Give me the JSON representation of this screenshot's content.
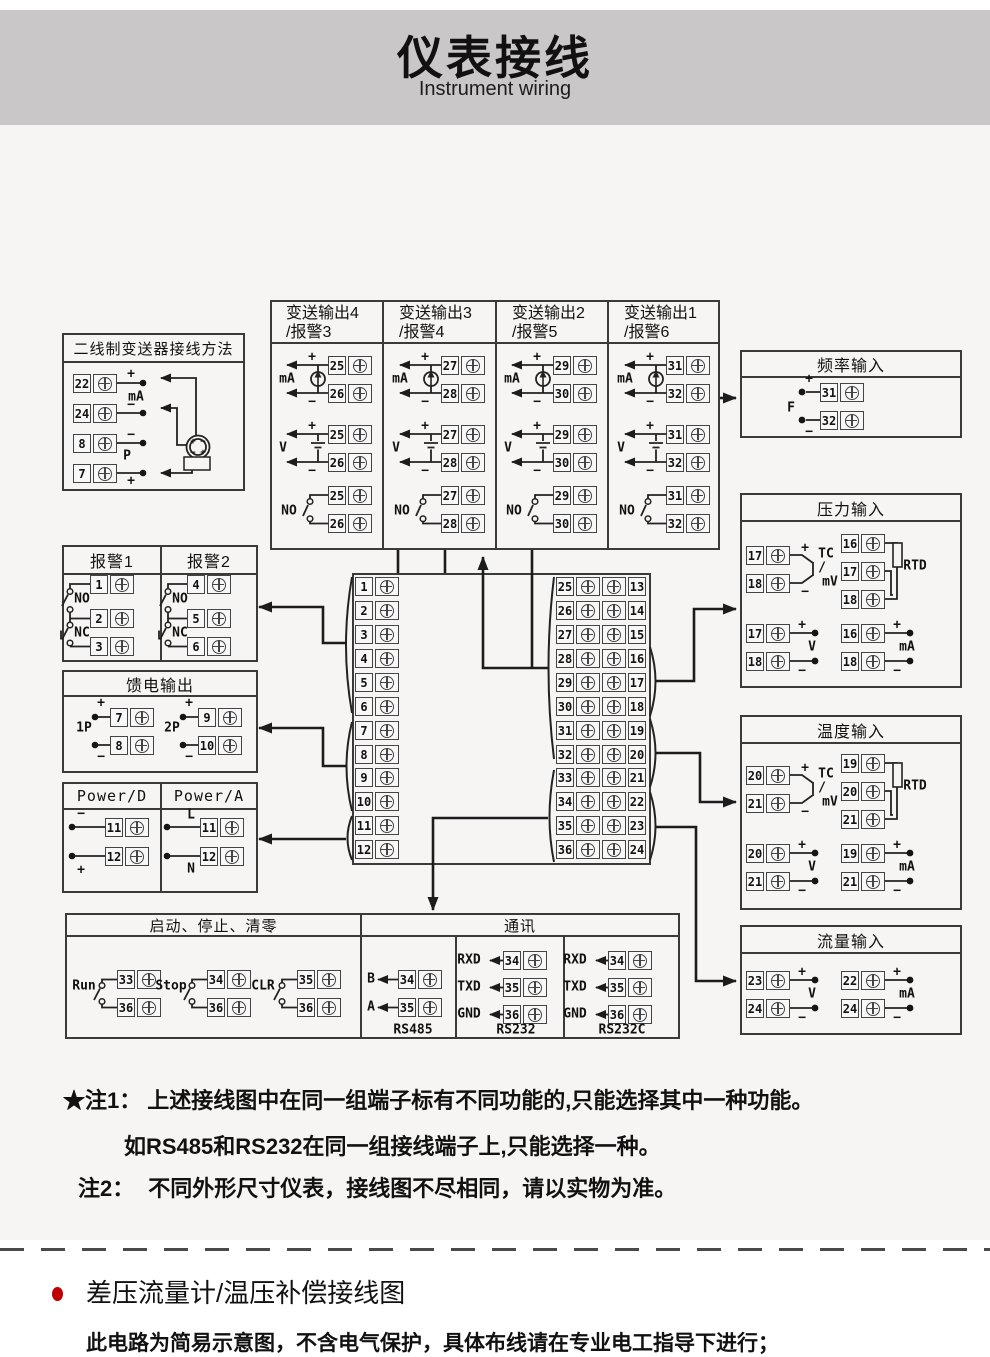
{
  "page": {
    "title": "仪表接线",
    "subtitle": "Instrument wiring"
  },
  "boxes": {
    "two_wire": {
      "title": "二线制变送器接线方法"
    },
    "transmit": {
      "columns": [
        {
          "t1": "变送输出4",
          "t2": "/报警3"
        },
        {
          "t1": "变送输出3",
          "t2": "/报警4"
        },
        {
          "t1": "变送输出2",
          "t2": "/报警5"
        },
        {
          "t1": "变送输出1",
          "t2": "/报警6"
        }
      ]
    },
    "freq": {
      "title": "频率输入"
    },
    "alarm1": {
      "title": "报警1"
    },
    "alarm2": {
      "title": "报警2"
    },
    "feed": {
      "title": "馈电输出"
    },
    "powerD": {
      "title": "Power/D"
    },
    "powerA": {
      "title": "Power/A"
    },
    "pressure": {
      "title": "压力输入"
    },
    "temperature": {
      "title": "温度输入"
    },
    "flow": {
      "title": "流量输入"
    },
    "control": {
      "title": "启动、停止、清零"
    },
    "comm": {
      "title": "通讯"
    }
  },
  "notes": {
    "n1_prefix": "★注1：",
    "n1_text": "上述接线图中在同一组端子标有不同功能的,只能选择其中一种功能。",
    "n1_line2": "如RS485和RS232在同一组接线端子上,只能选择一种。",
    "n2_prefix": "注2：",
    "n2_text": "不同外形尺寸仪表，接线图不尽相同，请以实物为准。"
  },
  "section": {
    "heading": "差压流量计/温压补偿接线图",
    "body": "此电路为简易示意图，不含电气保护，具体布线请在专业电工指导下进行；",
    "bullet_color": "#c00000"
  },
  "diagram": {
    "terminals": [
      [
        73,
        249,
        "22"
      ],
      [
        73,
        279,
        "24"
      ],
      [
        73,
        309,
        "8"
      ],
      [
        73,
        339,
        "7"
      ],
      [
        328,
        231,
        "25"
      ],
      [
        328,
        259,
        "26"
      ],
      [
        328,
        300,
        "25"
      ],
      [
        328,
        328,
        "26"
      ],
      [
        328,
        361,
        "25"
      ],
      [
        328,
        389,
        "26"
      ],
      [
        441,
        231,
        "27"
      ],
      [
        441,
        259,
        "28"
      ],
      [
        441,
        300,
        "27"
      ],
      [
        441,
        328,
        "28"
      ],
      [
        441,
        361,
        "27"
      ],
      [
        441,
        389,
        "28"
      ],
      [
        553,
        231,
        "29"
      ],
      [
        553,
        259,
        "30"
      ],
      [
        553,
        300,
        "29"
      ],
      [
        553,
        328,
        "30"
      ],
      [
        553,
        361,
        "29"
      ],
      [
        553,
        389,
        "30"
      ],
      [
        666,
        231,
        "31"
      ],
      [
        666,
        259,
        "32"
      ],
      [
        666,
        300,
        "31"
      ],
      [
        666,
        328,
        "32"
      ],
      [
        666,
        361,
        "31"
      ],
      [
        666,
        389,
        "32"
      ],
      [
        820,
        258,
        "31"
      ],
      [
        820,
        286,
        "32"
      ],
      [
        90,
        450,
        "1"
      ],
      [
        90,
        484,
        "2"
      ],
      [
        90,
        512,
        "3"
      ],
      [
        187,
        450,
        "4"
      ],
      [
        187,
        484,
        "5"
      ],
      [
        187,
        512,
        "6"
      ],
      [
        110,
        583,
        "7"
      ],
      [
        110,
        611,
        "8"
      ],
      [
        198,
        583,
        "9"
      ],
      [
        198,
        611,
        "10"
      ],
      [
        105,
        693,
        "11"
      ],
      [
        105,
        722,
        "12"
      ],
      [
        200,
        693,
        "11"
      ],
      [
        200,
        722,
        "12"
      ],
      [
        355,
        452,
        "1"
      ],
      [
        355,
        476,
        "2"
      ],
      [
        355,
        500,
        "3"
      ],
      [
        355,
        524,
        "4"
      ],
      [
        355,
        548,
        "5"
      ],
      [
        355,
        572,
        "6"
      ],
      [
        355,
        596,
        "7"
      ],
      [
        355,
        620,
        "8"
      ],
      [
        355,
        643,
        "9"
      ],
      [
        355,
        667,
        "10"
      ],
      [
        355,
        691,
        "11"
      ],
      [
        355,
        715,
        "12"
      ],
      [
        556,
        452,
        "25"
      ],
      [
        556,
        476,
        "26"
      ],
      [
        556,
        500,
        "27"
      ],
      [
        556,
        524,
        "28"
      ],
      [
        556,
        548,
        "29"
      ],
      [
        556,
        572,
        "30"
      ],
      [
        556,
        596,
        "31"
      ],
      [
        556,
        620,
        "32"
      ],
      [
        556,
        643,
        "33"
      ],
      [
        556,
        667,
        "34"
      ],
      [
        556,
        691,
        "35"
      ],
      [
        556,
        715,
        "36"
      ],
      [
        602,
        452,
        "13",
        "r"
      ],
      [
        602,
        476,
        "14",
        "r"
      ],
      [
        602,
        500,
        "15",
        "r"
      ],
      [
        602,
        524,
        "16",
        "r"
      ],
      [
        602,
        548,
        "17",
        "r"
      ],
      [
        602,
        572,
        "18",
        "r"
      ],
      [
        602,
        596,
        "19",
        "r"
      ],
      [
        602,
        620,
        "20",
        "r"
      ],
      [
        602,
        643,
        "21",
        "r"
      ],
      [
        602,
        667,
        "22",
        "r"
      ],
      [
        602,
        691,
        "23",
        "r"
      ],
      [
        602,
        715,
        "24",
        "r"
      ],
      [
        746,
        421,
        "17"
      ],
      [
        746,
        449,
        "18"
      ],
      [
        841,
        409,
        "16"
      ],
      [
        841,
        437,
        "17"
      ],
      [
        841,
        465,
        "18"
      ],
      [
        746,
        499,
        "17"
      ],
      [
        746,
        527,
        "18"
      ],
      [
        841,
        499,
        "16"
      ],
      [
        841,
        527,
        "18"
      ],
      [
        746,
        641,
        "20"
      ],
      [
        746,
        669,
        "21"
      ],
      [
        841,
        629,
        "19"
      ],
      [
        841,
        657,
        "20"
      ],
      [
        841,
        685,
        "21"
      ],
      [
        746,
        719,
        "20"
      ],
      [
        746,
        747,
        "21"
      ],
      [
        841,
        719,
        "19"
      ],
      [
        841,
        747,
        "21"
      ],
      [
        746,
        846,
        "23"
      ],
      [
        746,
        874,
        "24"
      ],
      [
        841,
        846,
        "22"
      ],
      [
        841,
        874,
        "24"
      ],
      [
        117,
        845,
        "33"
      ],
      [
        117,
        873,
        "36"
      ],
      [
        207,
        845,
        "34"
      ],
      [
        207,
        873,
        "36"
      ],
      [
        297,
        845,
        "35"
      ],
      [
        297,
        873,
        "36"
      ],
      [
        398,
        845,
        "34"
      ],
      [
        398,
        873,
        "35"
      ],
      [
        503,
        826,
        "34"
      ],
      [
        503,
        853,
        "35"
      ],
      [
        503,
        880,
        "36"
      ],
      [
        608,
        826,
        "34"
      ],
      [
        608,
        853,
        "35"
      ],
      [
        608,
        880,
        "36"
      ]
    ],
    "labels": [
      [
        131,
        249,
        "+"
      ],
      [
        136,
        272,
        "mA"
      ],
      [
        131,
        280,
        "−"
      ],
      [
        131,
        310,
        "−"
      ],
      [
        127,
        331,
        "P"
      ],
      [
        131,
        356,
        "+"
      ],
      [
        193,
        317,
        "+",
        9
      ],
      [
        203,
        317,
        "−",
        9
      ],
      [
        193,
        328,
        "−",
        9
      ],
      [
        203,
        328,
        "+",
        9
      ],
      [
        312,
        232,
        "+"
      ],
      [
        287,
        254,
        "mA"
      ],
      [
        312,
        277,
        "−"
      ],
      [
        312,
        301,
        "+"
      ],
      [
        283,
        323,
        "V"
      ],
      [
        312,
        346,
        "−"
      ],
      [
        289,
        386,
        "NO"
      ],
      [
        425,
        232,
        "+"
      ],
      [
        400,
        254,
        "mA"
      ],
      [
        425,
        277,
        "−"
      ],
      [
        425,
        301,
        "+"
      ],
      [
        396,
        323,
        "V"
      ],
      [
        425,
        346,
        "−"
      ],
      [
        402,
        386,
        "NO"
      ],
      [
        537,
        232,
        "+"
      ],
      [
        512,
        254,
        "mA"
      ],
      [
        537,
        277,
        "−"
      ],
      [
        537,
        301,
        "+"
      ],
      [
        508,
        323,
        "V"
      ],
      [
        537,
        346,
        "−"
      ],
      [
        514,
        386,
        "NO"
      ],
      [
        650,
        232,
        "+"
      ],
      [
        625,
        254,
        "mA"
      ],
      [
        650,
        277,
        "−"
      ],
      [
        650,
        301,
        "+"
      ],
      [
        621,
        323,
        "V"
      ],
      [
        650,
        346,
        "−"
      ],
      [
        627,
        386,
        "NO"
      ],
      [
        809,
        254,
        "+"
      ],
      [
        791,
        283,
        "F"
      ],
      [
        809,
        307,
        "−"
      ],
      [
        82,
        474,
        "NO"
      ],
      [
        82,
        508,
        "NC"
      ],
      [
        180,
        474,
        "NO"
      ],
      [
        180,
        508,
        "NC"
      ],
      [
        101,
        578,
        "+"
      ],
      [
        84,
        603,
        "1P"
      ],
      [
        101,
        632,
        "−"
      ],
      [
        189,
        578,
        "+"
      ],
      [
        172,
        603,
        "2P"
      ],
      [
        189,
        632,
        "−"
      ],
      [
        81,
        689,
        "−"
      ],
      [
        81,
        745,
        "+"
      ],
      [
        191,
        690,
        "L"
      ],
      [
        191,
        744,
        "N"
      ],
      [
        805,
        423,
        "+"
      ],
      [
        805,
        467,
        "−"
      ],
      [
        826,
        429,
        "TC"
      ],
      [
        822,
        443,
        "/"
      ],
      [
        830,
        457,
        "mV"
      ],
      [
        915,
        441,
        "RTD"
      ],
      [
        802,
        500,
        "+"
      ],
      [
        812,
        522,
        "V"
      ],
      [
        802,
        546,
        "−"
      ],
      [
        897,
        500,
        "+"
      ],
      [
        907,
        522,
        "mA"
      ],
      [
        897,
        546,
        "−"
      ],
      [
        805,
        643,
        "+"
      ],
      [
        805,
        687,
        "−"
      ],
      [
        826,
        649,
        "TC"
      ],
      [
        822,
        663,
        "/"
      ],
      [
        830,
        677,
        "mV"
      ],
      [
        915,
        661,
        "RTD"
      ],
      [
        802,
        720,
        "+"
      ],
      [
        812,
        742,
        "V"
      ],
      [
        802,
        766,
        "−"
      ],
      [
        897,
        720,
        "+"
      ],
      [
        907,
        742,
        "mA"
      ],
      [
        897,
        766,
        "−"
      ],
      [
        802,
        847,
        "+"
      ],
      [
        812,
        869,
        "V"
      ],
      [
        802,
        893,
        "−"
      ],
      [
        897,
        847,
        "+"
      ],
      [
        907,
        869,
        "mA"
      ],
      [
        897,
        893,
        "−"
      ],
      [
        84,
        861,
        "Run"
      ],
      [
        171,
        861,
        "Stop"
      ],
      [
        263,
        861,
        "CLR"
      ],
      [
        371,
        854,
        "B"
      ],
      [
        371,
        882,
        "A"
      ],
      [
        413,
        905,
        "RS485"
      ],
      [
        469,
        835,
        "RXD"
      ],
      [
        469,
        862,
        "TXD"
      ],
      [
        469,
        889,
        "GND"
      ],
      [
        516,
        905,
        "RS232"
      ],
      [
        575,
        835,
        "RXD"
      ],
      [
        575,
        862,
        "TXD"
      ],
      [
        575,
        889,
        "GND"
      ],
      [
        622,
        905,
        "RS232C"
      ]
    ]
  }
}
